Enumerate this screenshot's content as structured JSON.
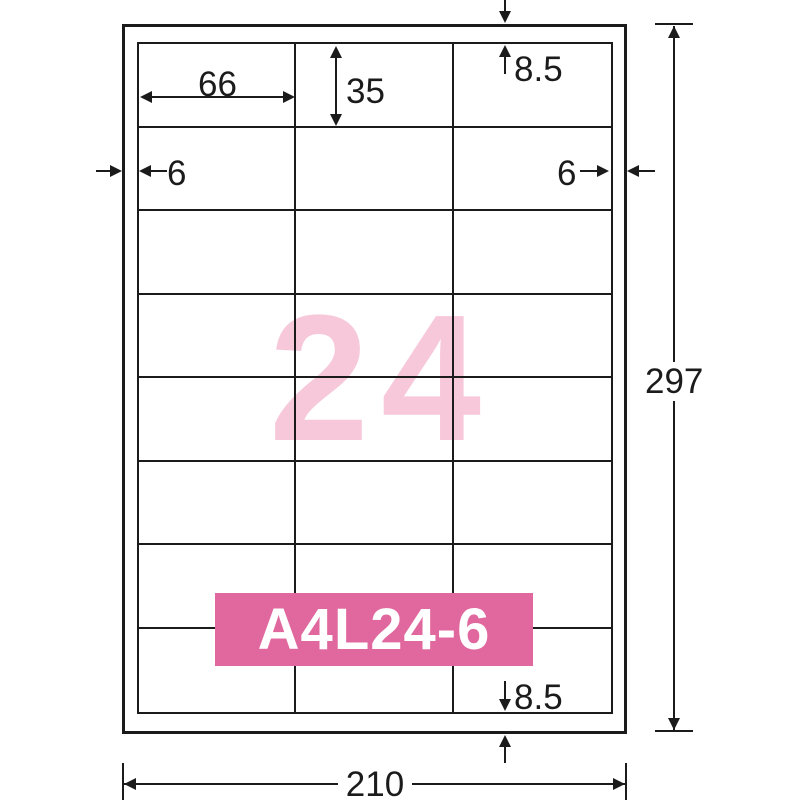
{
  "diagram": {
    "product_code": "A4L24-6",
    "label_count": "24",
    "grid": {
      "columns": 3,
      "rows": 8
    },
    "dims": {
      "label_width": "66",
      "label_height": "35",
      "top_margin": "8.5",
      "bottom_margin": "8.5",
      "left_margin": "6",
      "right_margin": "6",
      "page_width": "210",
      "page_height": "297"
    },
    "colors": {
      "banner": "#e0689e",
      "watermark": "#f7c8da",
      "line": "#1b1b1b"
    }
  }
}
